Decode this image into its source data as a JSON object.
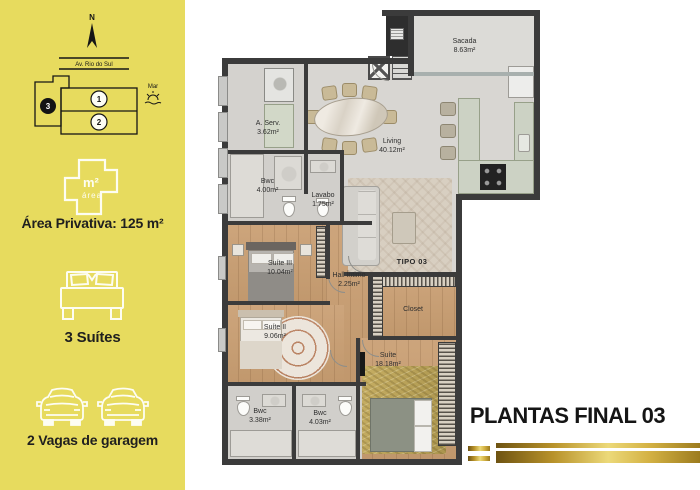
{
  "sidebar": {
    "background": "#e7db5e",
    "map": {
      "compass": "N",
      "street": "Av. Rio do Sul",
      "sea": "Mar",
      "units": [
        "1",
        "2",
        "3"
      ],
      "highlighted_unit": "3"
    },
    "features": [
      {
        "icon": "area-plan-icon",
        "icon_main": "m²",
        "icon_sub": "área",
        "label": "Área Privativa: 125 m²"
      },
      {
        "icon": "bed-icon",
        "label": "3 Suítes"
      },
      {
        "icon": "car-icon",
        "label": "2 Vagas de garagem"
      }
    ]
  },
  "floorplan": {
    "unit_type": "TIPO 03",
    "rooms": [
      {
        "name": "Sacada",
        "area": "8.63m²"
      },
      {
        "name": "A. Serv.",
        "area": "3.62m²"
      },
      {
        "name": "Living",
        "area": "40.12m²"
      },
      {
        "name": "Bwc",
        "area": "4.00m²"
      },
      {
        "name": "Lavabo",
        "area": "1.75m²"
      },
      {
        "name": "Suíte III",
        "area": "10.04m²"
      },
      {
        "name": "Hall Íntimo",
        "area": "2.25m²"
      },
      {
        "name": "Closet",
        "area": ""
      },
      {
        "name": "Suíte II",
        "area": "9.06m²"
      },
      {
        "name": "Suíte",
        "area": "18.18m²"
      },
      {
        "name": "Bwc",
        "area": "3.38m²"
      },
      {
        "name": "Bwc",
        "area": "4.03m²"
      }
    ]
  },
  "footer": {
    "title": "PLANTAS FINAL 03",
    "accent_gold": "#c9a52f"
  },
  "colors": {
    "sidebar_yellow": "#e7db5e",
    "wall": "#3b3b3b",
    "wood_floor": "#c9a077",
    "text_dark": "#1f1f1f"
  }
}
